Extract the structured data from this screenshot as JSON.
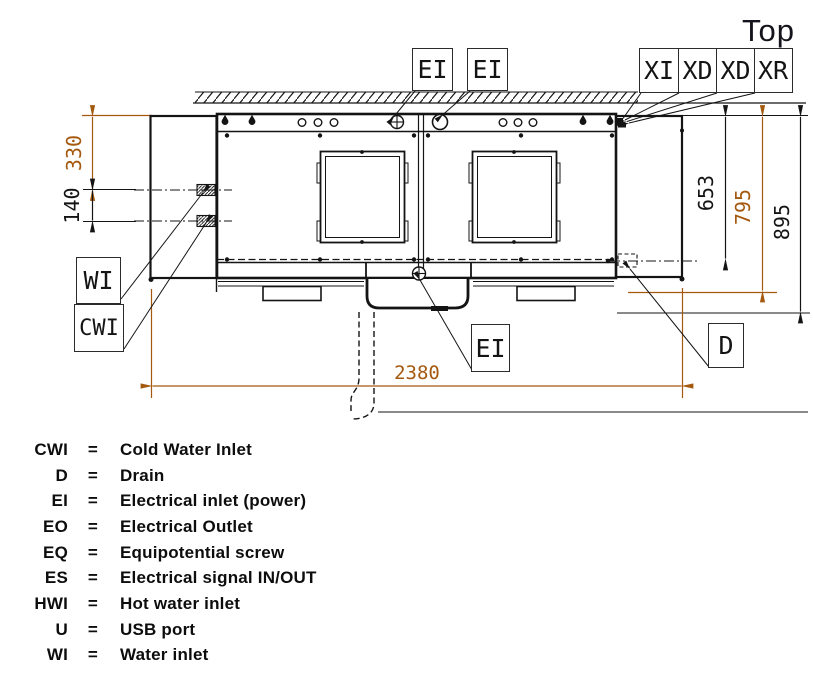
{
  "title": "Top",
  "callouts": {
    "ei_top_1": "EI",
    "ei_top_2": "EI",
    "xi": "XI",
    "xd_1": "XD",
    "xd_2": "XD",
    "xr": "XR",
    "wi": "WI",
    "cwi": "CWI",
    "ei_bottom": "EI",
    "d": "D"
  },
  "dimensions": {
    "left_top": "330",
    "left_mid": "140",
    "right_inner": "653",
    "right_mid": "795",
    "right_outer": "895",
    "bottom_width": "2380"
  },
  "colors": {
    "dimension_accent": "#a5590f",
    "line": "#141414"
  },
  "legend": [
    {
      "abbr": "CWI",
      "eq": "=",
      "desc": "Cold Water Inlet"
    },
    {
      "abbr": "D",
      "eq": "=",
      "desc": "Drain"
    },
    {
      "abbr": "EI",
      "eq": "=",
      "desc": "Electrical inlet (power)"
    },
    {
      "abbr": "EO",
      "eq": "=",
      "desc": "Electrical Outlet"
    },
    {
      "abbr": "EQ",
      "eq": "=",
      "desc": "Equipotential screw"
    },
    {
      "abbr": "ES",
      "eq": "=",
      "desc": "Electrical signal IN/OUT"
    },
    {
      "abbr": "HWI",
      "eq": "=",
      "desc": "Hot water inlet"
    },
    {
      "abbr": "U",
      "eq": "=",
      "desc": "USB port"
    },
    {
      "abbr": "WI",
      "eq": "=",
      "desc": "Water inlet"
    }
  ]
}
